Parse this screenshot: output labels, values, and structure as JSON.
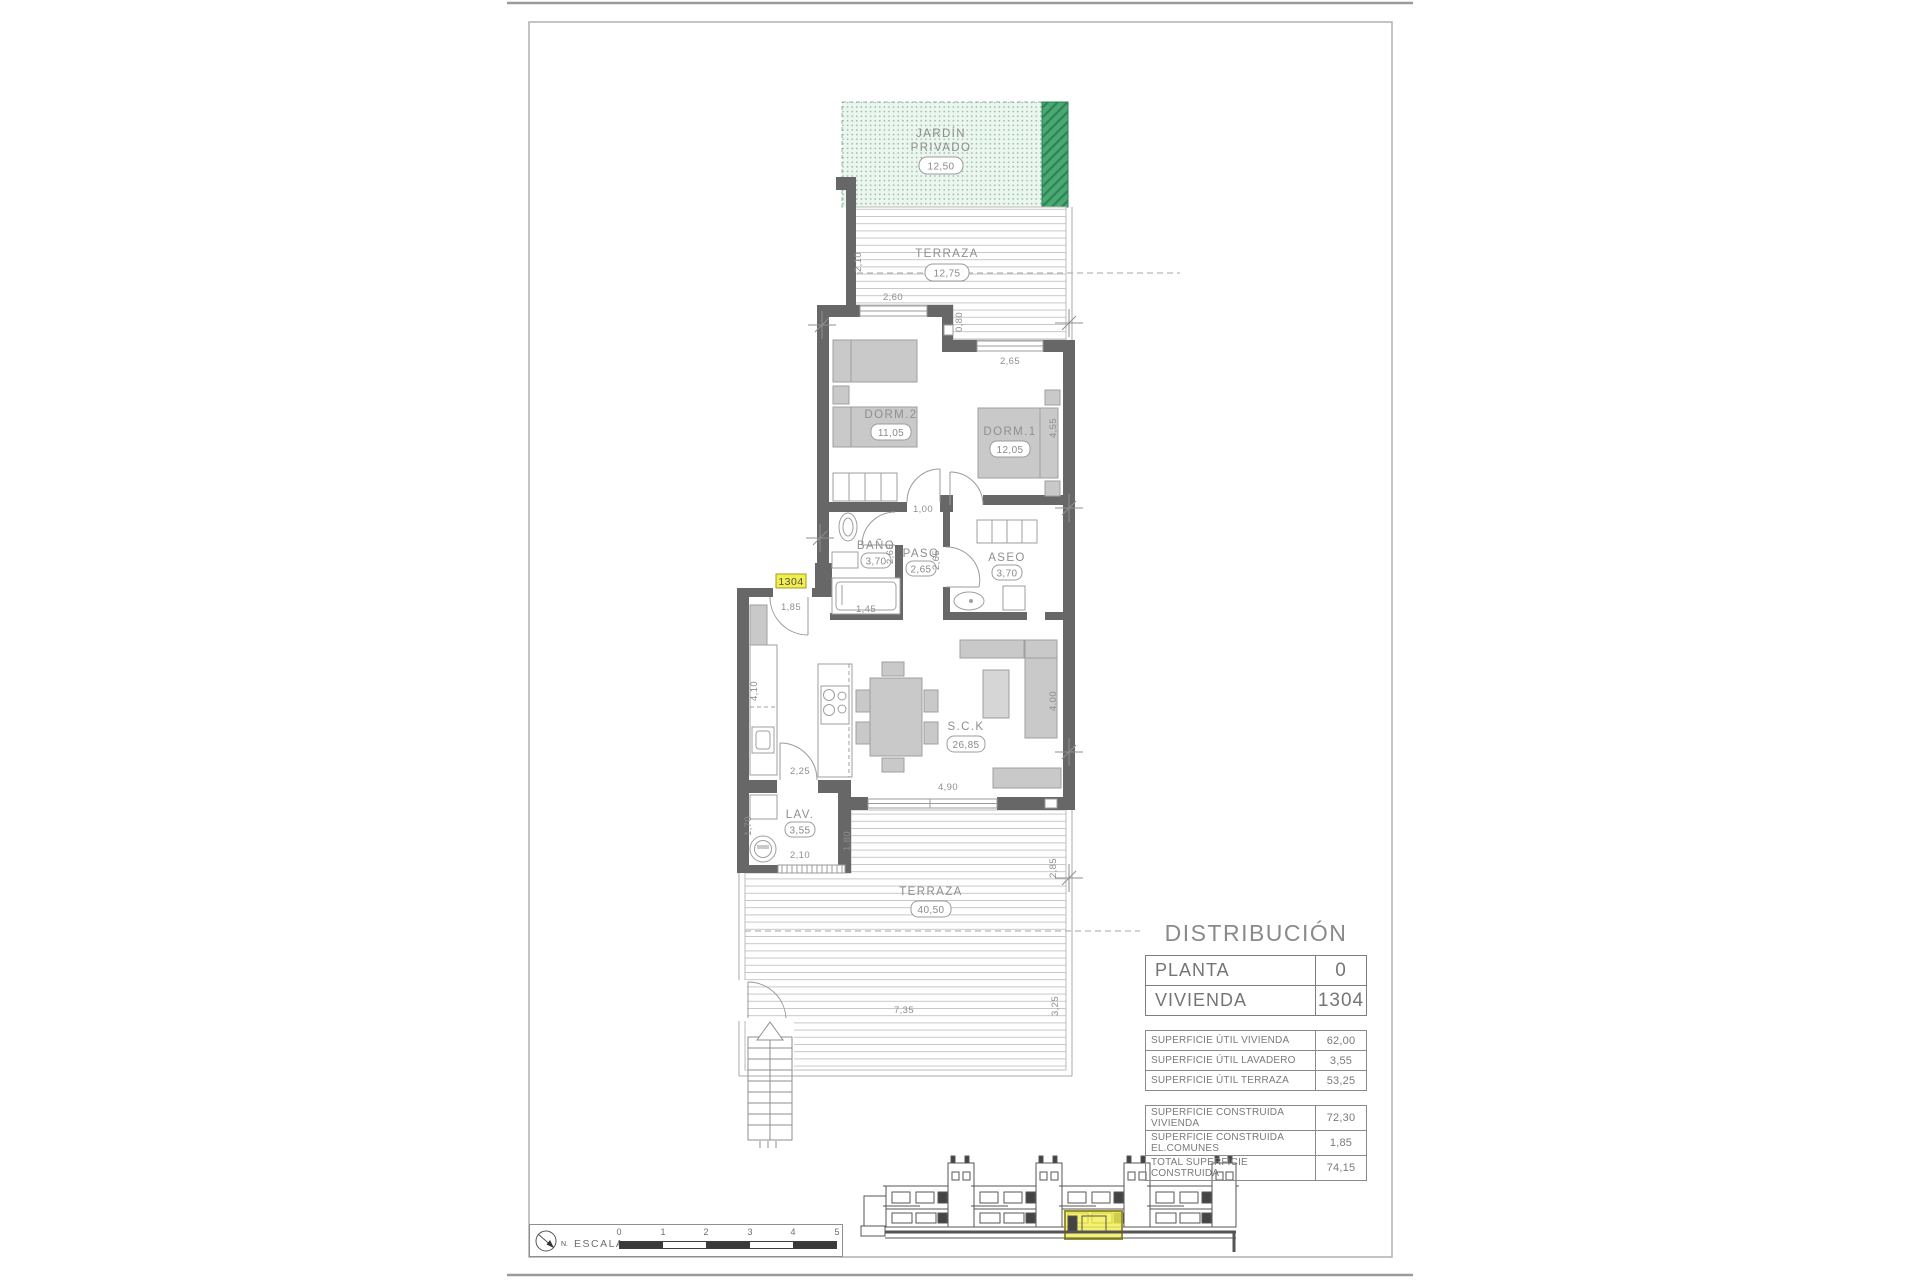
{
  "plan": {
    "unit_badge": "1304",
    "rooms": {
      "jardin": {
        "line1": "JARDÍN",
        "line2": "PRIVADO",
        "area": "12,50"
      },
      "terraza_norte": {
        "name": "TERRAZA",
        "area": "12,75"
      },
      "dorm2": {
        "name": "DORM.2",
        "area": "11,05"
      },
      "dorm1": {
        "name": "DORM.1",
        "area": "12,05"
      },
      "bano": {
        "name": "BAÑO",
        "area": "3,70"
      },
      "paso": {
        "name": "PASO",
        "area": "2,65"
      },
      "aseo": {
        "name": "ASEO",
        "area": "3,70"
      },
      "salon": {
        "name": "S.C.K",
        "area": "26,85"
      },
      "lavadero": {
        "name": "LAV.",
        "area": "3,55"
      },
      "terraza_sur": {
        "name": "TERRAZA",
        "area": "40,50"
      }
    },
    "dims": {
      "terraza_norte_fondo": "2,10",
      "dorm2_ancho": "2,60",
      "terraza_paso": "0,80",
      "dorm1_ancho": "2,65",
      "dorm1_fondo": "4,55",
      "dorm2_puerta": "1,00",
      "bano_fondo": "2,65",
      "paso_fondo": "2,65",
      "bano_ancho": "1,45",
      "entrada_ancho": "1,85",
      "cocina_fondo": "4,10",
      "lavadero_puerta": "2,25",
      "lavadero_fondo": "1,70",
      "lavadero_ancho": "2,10",
      "terraza_sur_fondo_izq": "1,80",
      "salon_ventanal": "4,90",
      "salon_fondo": "4,00",
      "terraza_sur_fondo_der": "2,85",
      "terraza_sur_ancho": "7,35",
      "terraza_sur_lateral": "3,25"
    }
  },
  "distribution": {
    "title": "DISTRIBUCIÓN",
    "header_rows": [
      {
        "label": "PLANTA",
        "value": "0"
      },
      {
        "label": "VIVIENDA",
        "value": "1304"
      }
    ],
    "util_rows": [
      {
        "label": "SUPERFICIE ÚTIL VIVIENDA",
        "value": "62,00"
      },
      {
        "label": "SUPERFICIE ÚTIL LAVADERO",
        "value": "3,55"
      },
      {
        "label": "SUPERFICIE ÚTIL TERRAZA",
        "value": "53,25"
      }
    ],
    "built_rows": [
      {
        "label": "SUPERFICIE CONSTRUIDA VIVIENDA",
        "value": "72,30"
      },
      {
        "label": "SUPERFICIE CONSTRUIDA EL.COMUNES",
        "value": "1,85"
      },
      {
        "label": "TOTAL SUPERFICIE CONSTRUIDA",
        "value": "74,15"
      }
    ]
  },
  "footer": {
    "escala_label": "ESCALA :",
    "north_label": "N.",
    "scale_ticks": [
      "0",
      "1",
      "2",
      "3",
      "4",
      "5"
    ]
  },
  "colors": {
    "wall": "#676767",
    "garden_light": "#ecf5ef",
    "garden_dark": "#4aa873",
    "highlight_yellow": "#f2ee4e",
    "line_gray": "#9b9b9b",
    "text_gray": "#8a8a8a"
  }
}
